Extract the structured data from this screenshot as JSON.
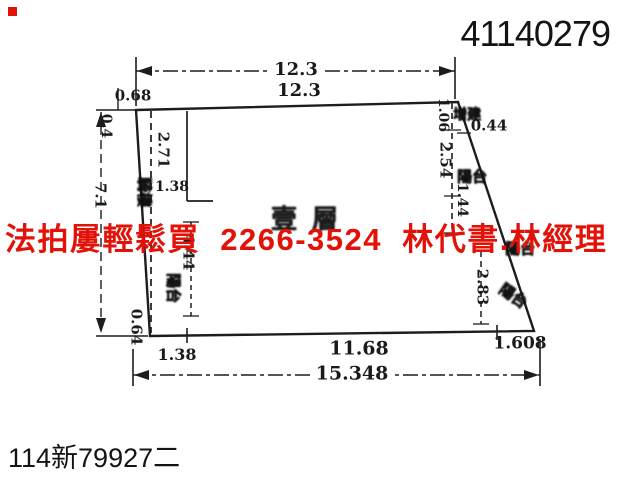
{
  "scan": {
    "doc_number": "41140279",
    "case_number": "114新79927二"
  },
  "overlay": {
    "ad_text": "法拍屢輕鬆買  2266-3524  林代書.林經理",
    "ad_color": "#e31208"
  },
  "diagram": {
    "floor_label": "壹層",
    "dims": {
      "top_total": "12.3",
      "top_edge": "12.3",
      "left_offset_top": "0.68",
      "left_small": "0.4",
      "left_total": "7.1",
      "inner_height": "2.71",
      "inner_width_top": "1.38",
      "inner_balcony_len": "4.44",
      "left_bottom": "0.64",
      "bottom_left": "1.38",
      "bottom_mid": "11.68",
      "bottom_right": "1.608",
      "bottom_total": "15.348",
      "right_seg1": "1.06",
      "right_seg2": "2.54",
      "right_seg3": "1.44",
      "right_offset": "0.44",
      "right_seg4": "2.83"
    },
    "annotations": {
      "arcade": "騎樓",
      "extension": "增建",
      "balcony_left": "陽台",
      "balcony_right_mid": "陽台",
      "balcony_right_low": "陽台",
      "balcony_right_bottom": "陽台"
    }
  }
}
